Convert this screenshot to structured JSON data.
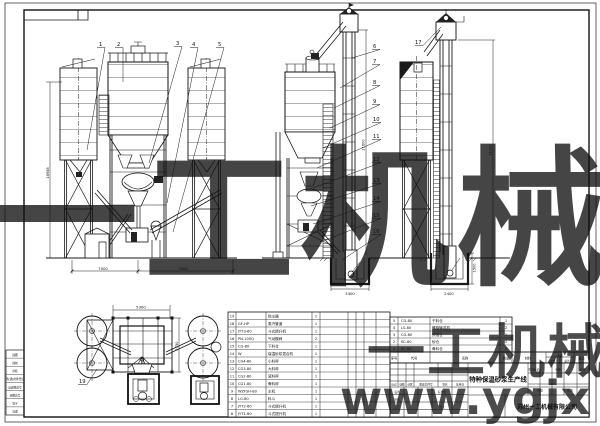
{
  "watermarks": {
    "center": "一工机械",
    "bottom": "一工机械",
    "url": "www.ygjx",
    "color": "#aecdf0"
  },
  "title_block": {
    "title": "特种保温砂浆生产线",
    "company": "苏州一工机械有限公司",
    "labels": {
      "mark": "标记",
      "count": "处数",
      "zone": "分区",
      "change_doc": "更改文件号",
      "sign": "签名",
      "date": "年月日",
      "design": "设计",
      "check": "审核",
      "craft": "工艺",
      "standard": "标准化",
      "approve": "批准",
      "stage_mark": "阶段标记",
      "weight": "重量",
      "scale": "比例",
      "sheet_total": "共 张",
      "sheet_no": "第 张"
    }
  },
  "bom_header": {
    "no": "序号",
    "code": "代号",
    "name": "名称",
    "qty": "数量",
    "material": "材料",
    "weight": "重量",
    "unit": "单件",
    "total": "总计",
    "remark": "备注"
  },
  "bom_left": {
    "rows": [
      {
        "no": "19",
        "code": "",
        "name": "除尘器",
        "qty": "1"
      },
      {
        "no": "18",
        "code": "GF-HP",
        "name": "蒸汽管道",
        "qty": "1"
      },
      {
        "no": "17",
        "code": "JYT3-60",
        "name": "斗式提升机",
        "qty": "1"
      },
      {
        "no": "16",
        "code": "PN-100Q",
        "name": "气动蝶阀",
        "qty": "2"
      },
      {
        "no": "15",
        "code": "CG-80",
        "name": "下料仓",
        "qty": "1"
      },
      {
        "no": "14",
        "code": "W",
        "name": "保温砂浆混合机",
        "qty": "1"
      },
      {
        "no": "13",
        "code": "CG4-80",
        "name": "小料秤",
        "qty": "1"
      },
      {
        "no": "12",
        "code": "CG3-80",
        "name": "大料秤",
        "qty": "1"
      },
      {
        "no": "11",
        "code": "CG2-80",
        "name": "液料秤",
        "qty": "1"
      },
      {
        "no": "10",
        "code": "CG1-80",
        "name": "骨料秤",
        "qty": "1"
      },
      {
        "no": "9",
        "code": "WZFSH-80",
        "name": "主机",
        "qty": "1"
      },
      {
        "no": "8",
        "code": "LG-80",
        "name": "料斗",
        "qty": "1"
      },
      {
        "no": "7",
        "code": "JYT2-60",
        "name": "斗式提升机",
        "qty": "1"
      },
      {
        "no": "6",
        "code": "JYT1-60",
        "name": "斗式提升机",
        "qty": "1"
      }
    ]
  },
  "bom_right": {
    "rows": [
      {
        "no": "5",
        "code": "CG-80",
        "name": "干料仓",
        "qty": "1"
      },
      {
        "no": "4",
        "code": "LS-80",
        "name": "螺旋输送机",
        "qty": "2"
      },
      {
        "no": "3",
        "code": "CG-80",
        "name": "预混仓",
        "qty": "1"
      },
      {
        "no": "2",
        "code": "KC-80",
        "name": "砂仓",
        "qty": "1"
      },
      {
        "no": "1",
        "code": "KC-80",
        "name": "骨料仓",
        "qty": "1"
      }
    ]
  },
  "margin_block": {
    "rows": [
      "描图",
      "描校",
      "审核",
      "借(通)用件登记",
      "旧底图总号",
      "底图总号",
      "签字",
      "日期"
    ]
  },
  "callouts": {
    "view_a": [
      "1",
      "2",
      "3",
      "4",
      "5"
    ],
    "view_b": [
      "6",
      "7",
      "8",
      "9",
      "10",
      "11",
      "12",
      "13",
      "14",
      "15",
      "16"
    ],
    "view_c": [
      "17"
    ],
    "plan": [
      "19"
    ]
  },
  "dimensions": {
    "a_span_left": "7000",
    "a_span_right": "7000",
    "a_height": "18958",
    "b_height": "21600",
    "b_pit_width": "3400",
    "c_height": "21100",
    "c_pit_width": "2400",
    "c_pit_depth": "1500",
    "plan_width": "5300",
    "plan_depth": "2750"
  }
}
